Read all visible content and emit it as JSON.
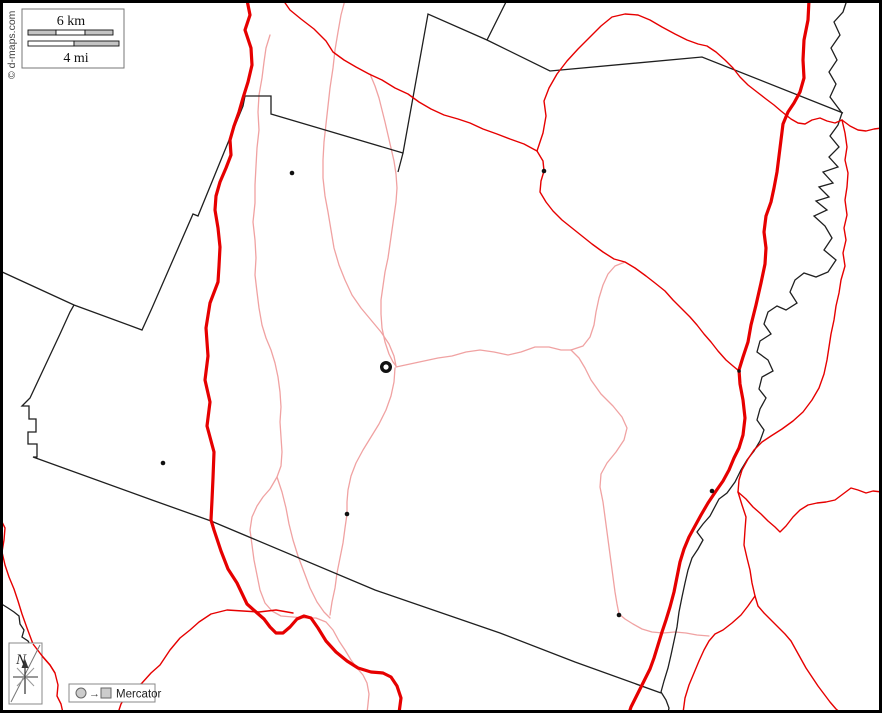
{
  "map": {
    "title": "blank-outline-map",
    "copyright": "© d-maps.com",
    "scale_box": {
      "km_label": "6 km",
      "mi_label": "4 mi"
    },
    "compass": {
      "north_label": "N"
    },
    "legend": {
      "arrow_glyph": "→",
      "projection_label": "Mercator"
    },
    "colors": {
      "frame": "#000000",
      "background": "#ffffff",
      "major_road": "#e60000",
      "secondary_road": "#e60000",
      "minor_road": "#f0a2a2",
      "boundary": "#1f1f1f",
      "river": "#1f1f1f",
      "symbol_fill": "#cccccc",
      "box_border": "#777777"
    },
    "symbols": {
      "city_ring": "main-city-ring",
      "town_dot": "town-dot"
    }
  }
}
